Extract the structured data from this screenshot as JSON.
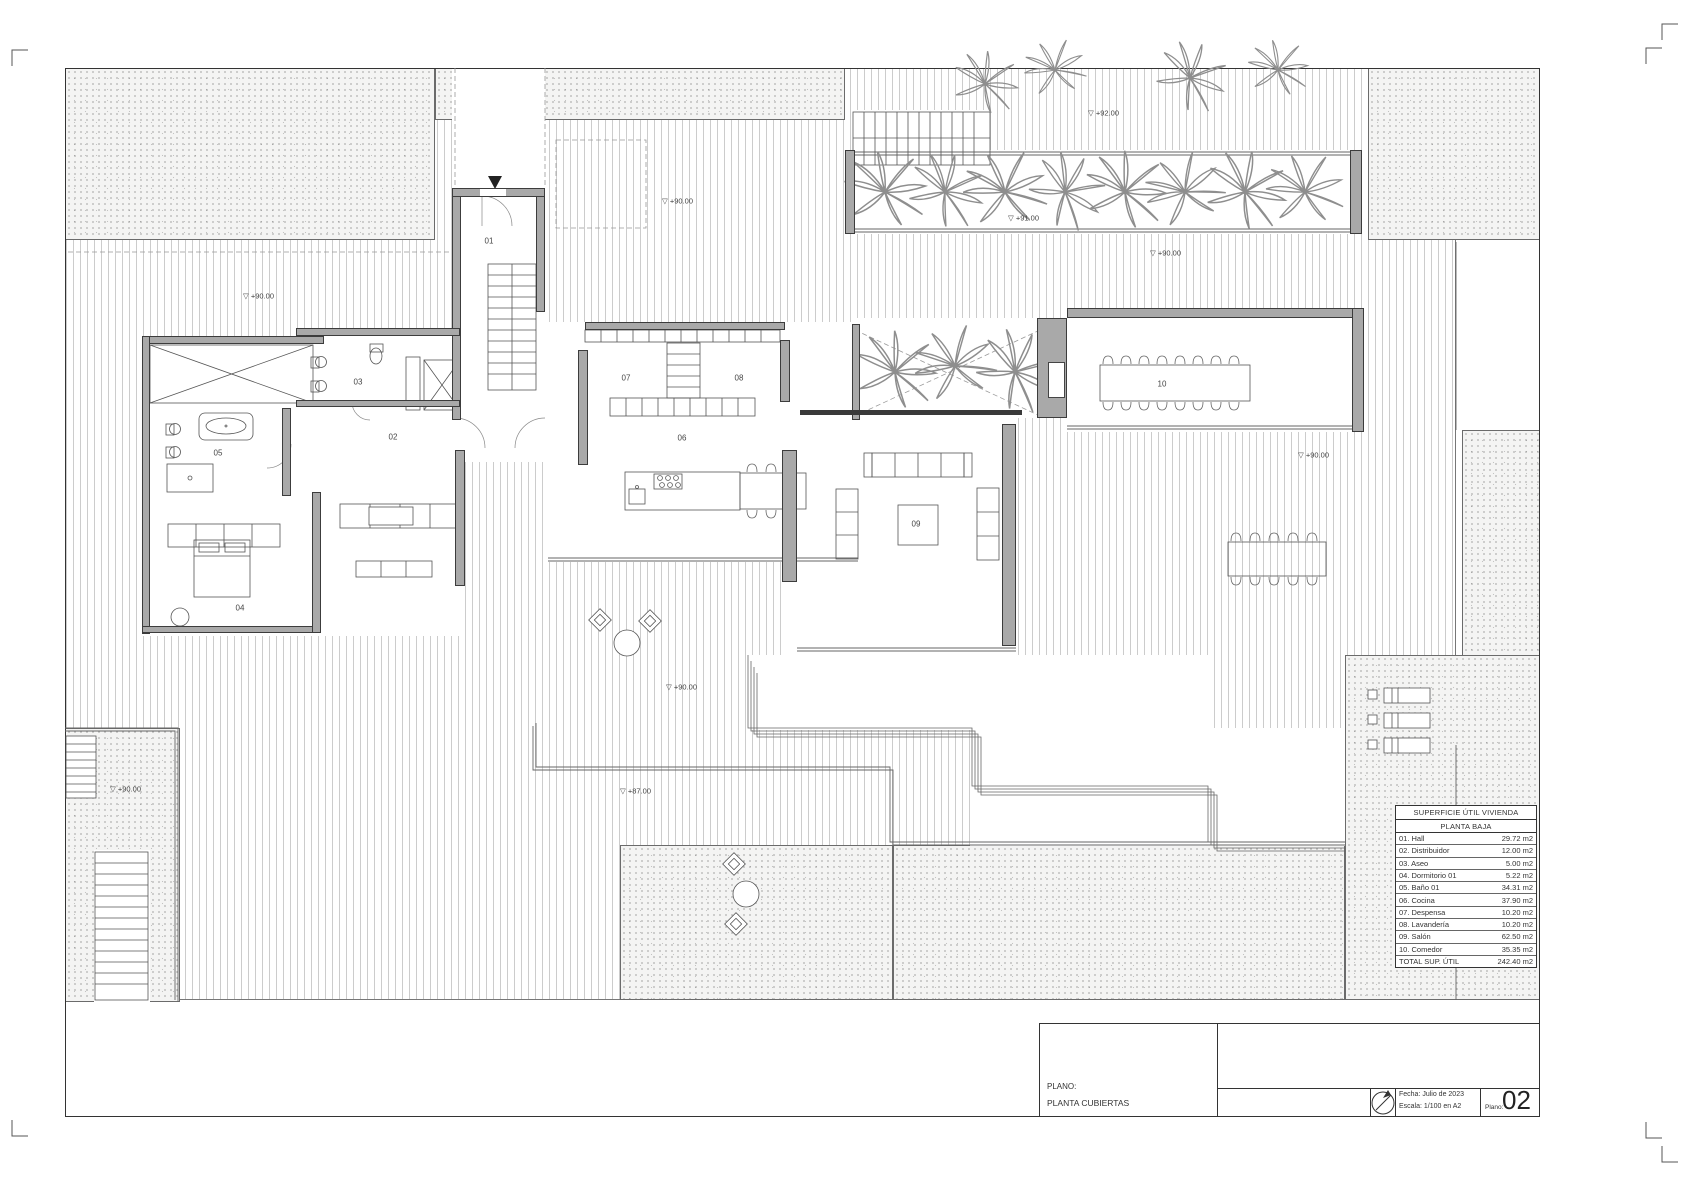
{
  "area_table": {
    "title": "SUPERFICIE ÚTIL VIVIENDA",
    "subtitle": "PLANTA BAJA",
    "rows": [
      {
        "label": "01. Hall",
        "value": "29.72 m2"
      },
      {
        "label": "02. Distribuidor",
        "value": "12.00 m2"
      },
      {
        "label": "03. Aseo",
        "value": "5.00 m2"
      },
      {
        "label": "04. Dormitorio 01",
        "value": "5.22 m2"
      },
      {
        "label": "05. Baño 01",
        "value": "34.31 m2"
      },
      {
        "label": "06. Cocina",
        "value": "37.90 m2"
      },
      {
        "label": "07. Despensa",
        "value": "10.20 m2"
      },
      {
        "label": "08. Lavandería",
        "value": "10.20 m2"
      },
      {
        "label": "09. Salón",
        "value": "62.50 m2"
      },
      {
        "label": "10. Comedor",
        "value": "35.35 m2"
      }
    ],
    "total_label": "TOTAL SUP. ÚTIL",
    "total_value": "242.40 m2"
  },
  "title_block": {
    "plano_label": "PLANO:",
    "plano_name": "PLANTA CUBIERTAS",
    "fecha": "Fecha: Julio de 2023",
    "escala": "Escala: 1/100 en A2",
    "sheet_no_label": "Plano:",
    "sheet_no": "02"
  },
  "plan": {
    "level_symbol": "▽",
    "room_labels": [
      {
        "num": "01",
        "x": 489,
        "y": 241
      },
      {
        "num": "02",
        "x": 393,
        "y": 437
      },
      {
        "num": "03",
        "x": 358,
        "y": 382
      },
      {
        "num": "04",
        "x": 240,
        "y": 608
      },
      {
        "num": "05",
        "x": 218,
        "y": 453
      },
      {
        "num": "06",
        "x": 682,
        "y": 438
      },
      {
        "num": "07",
        "x": 626,
        "y": 378
      },
      {
        "num": "08",
        "x": 739,
        "y": 378
      },
      {
        "num": "09",
        "x": 916,
        "y": 524
      },
      {
        "num": "10",
        "x": 1162,
        "y": 384
      }
    ],
    "level_marks": [
      {
        "text": "+92.00",
        "x": 1088,
        "y": 113
      },
      {
        "text": "+90.00",
        "x": 662,
        "y": 201
      },
      {
        "text": "+91.00",
        "x": 1008,
        "y": 218
      },
      {
        "text": "+90.00",
        "x": 1150,
        "y": 253
      },
      {
        "text": "+90.00",
        "x": 243,
        "y": 296
      },
      {
        "text": "+90.00",
        "x": 1298,
        "y": 455
      },
      {
        "text": "+90.00",
        "x": 666,
        "y": 687
      },
      {
        "text": "+90.00",
        "x": 110,
        "y": 789
      },
      {
        "text": "+87.00",
        "x": 620,
        "y": 791
      }
    ]
  }
}
